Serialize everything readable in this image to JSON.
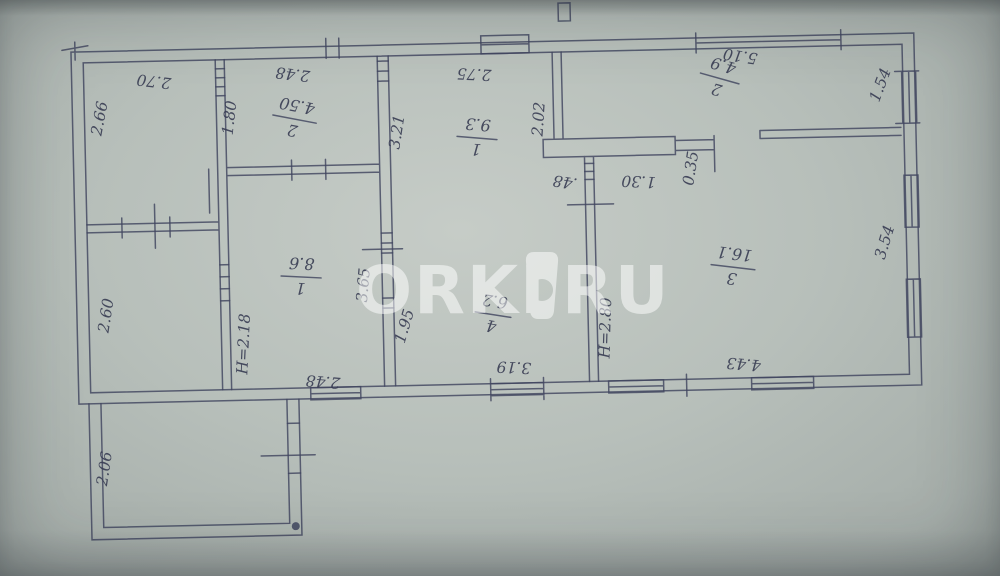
{
  "watermark": {
    "left": "ORKI",
    "right": "RU",
    "color": "#ffffff"
  },
  "plan": {
    "rooms": [
      {
        "number": "2",
        "area": "4.50"
      },
      {
        "number": "1",
        "area": "9.3"
      },
      {
        "number": "2",
        "area": "4.9"
      },
      {
        "number": "1",
        "area": "8.6"
      },
      {
        "number": "4",
        "area": "6.2"
      },
      {
        "number": "3",
        "area": "16.1"
      }
    ],
    "dims": {
      "w270": "2.70",
      "w266": "2.66",
      "w248_top": "2.48",
      "w180": "1.80",
      "w275": "2.75",
      "w321": "3.21",
      "w202": "2.02",
      "w510": "5.10",
      "w154": "1.54",
      "w048": ".48",
      "w130": "1.30",
      "w035": "0.35",
      "w354": "3.54",
      "w260": "2.60",
      "h218": "H=2.18",
      "w365": "3.65",
      "w195": "1.95",
      "w248_bottom": "2.48",
      "w319": "3.19",
      "h280": "H=2.80",
      "w443": "4.43",
      "w206": "2.06"
    }
  }
}
